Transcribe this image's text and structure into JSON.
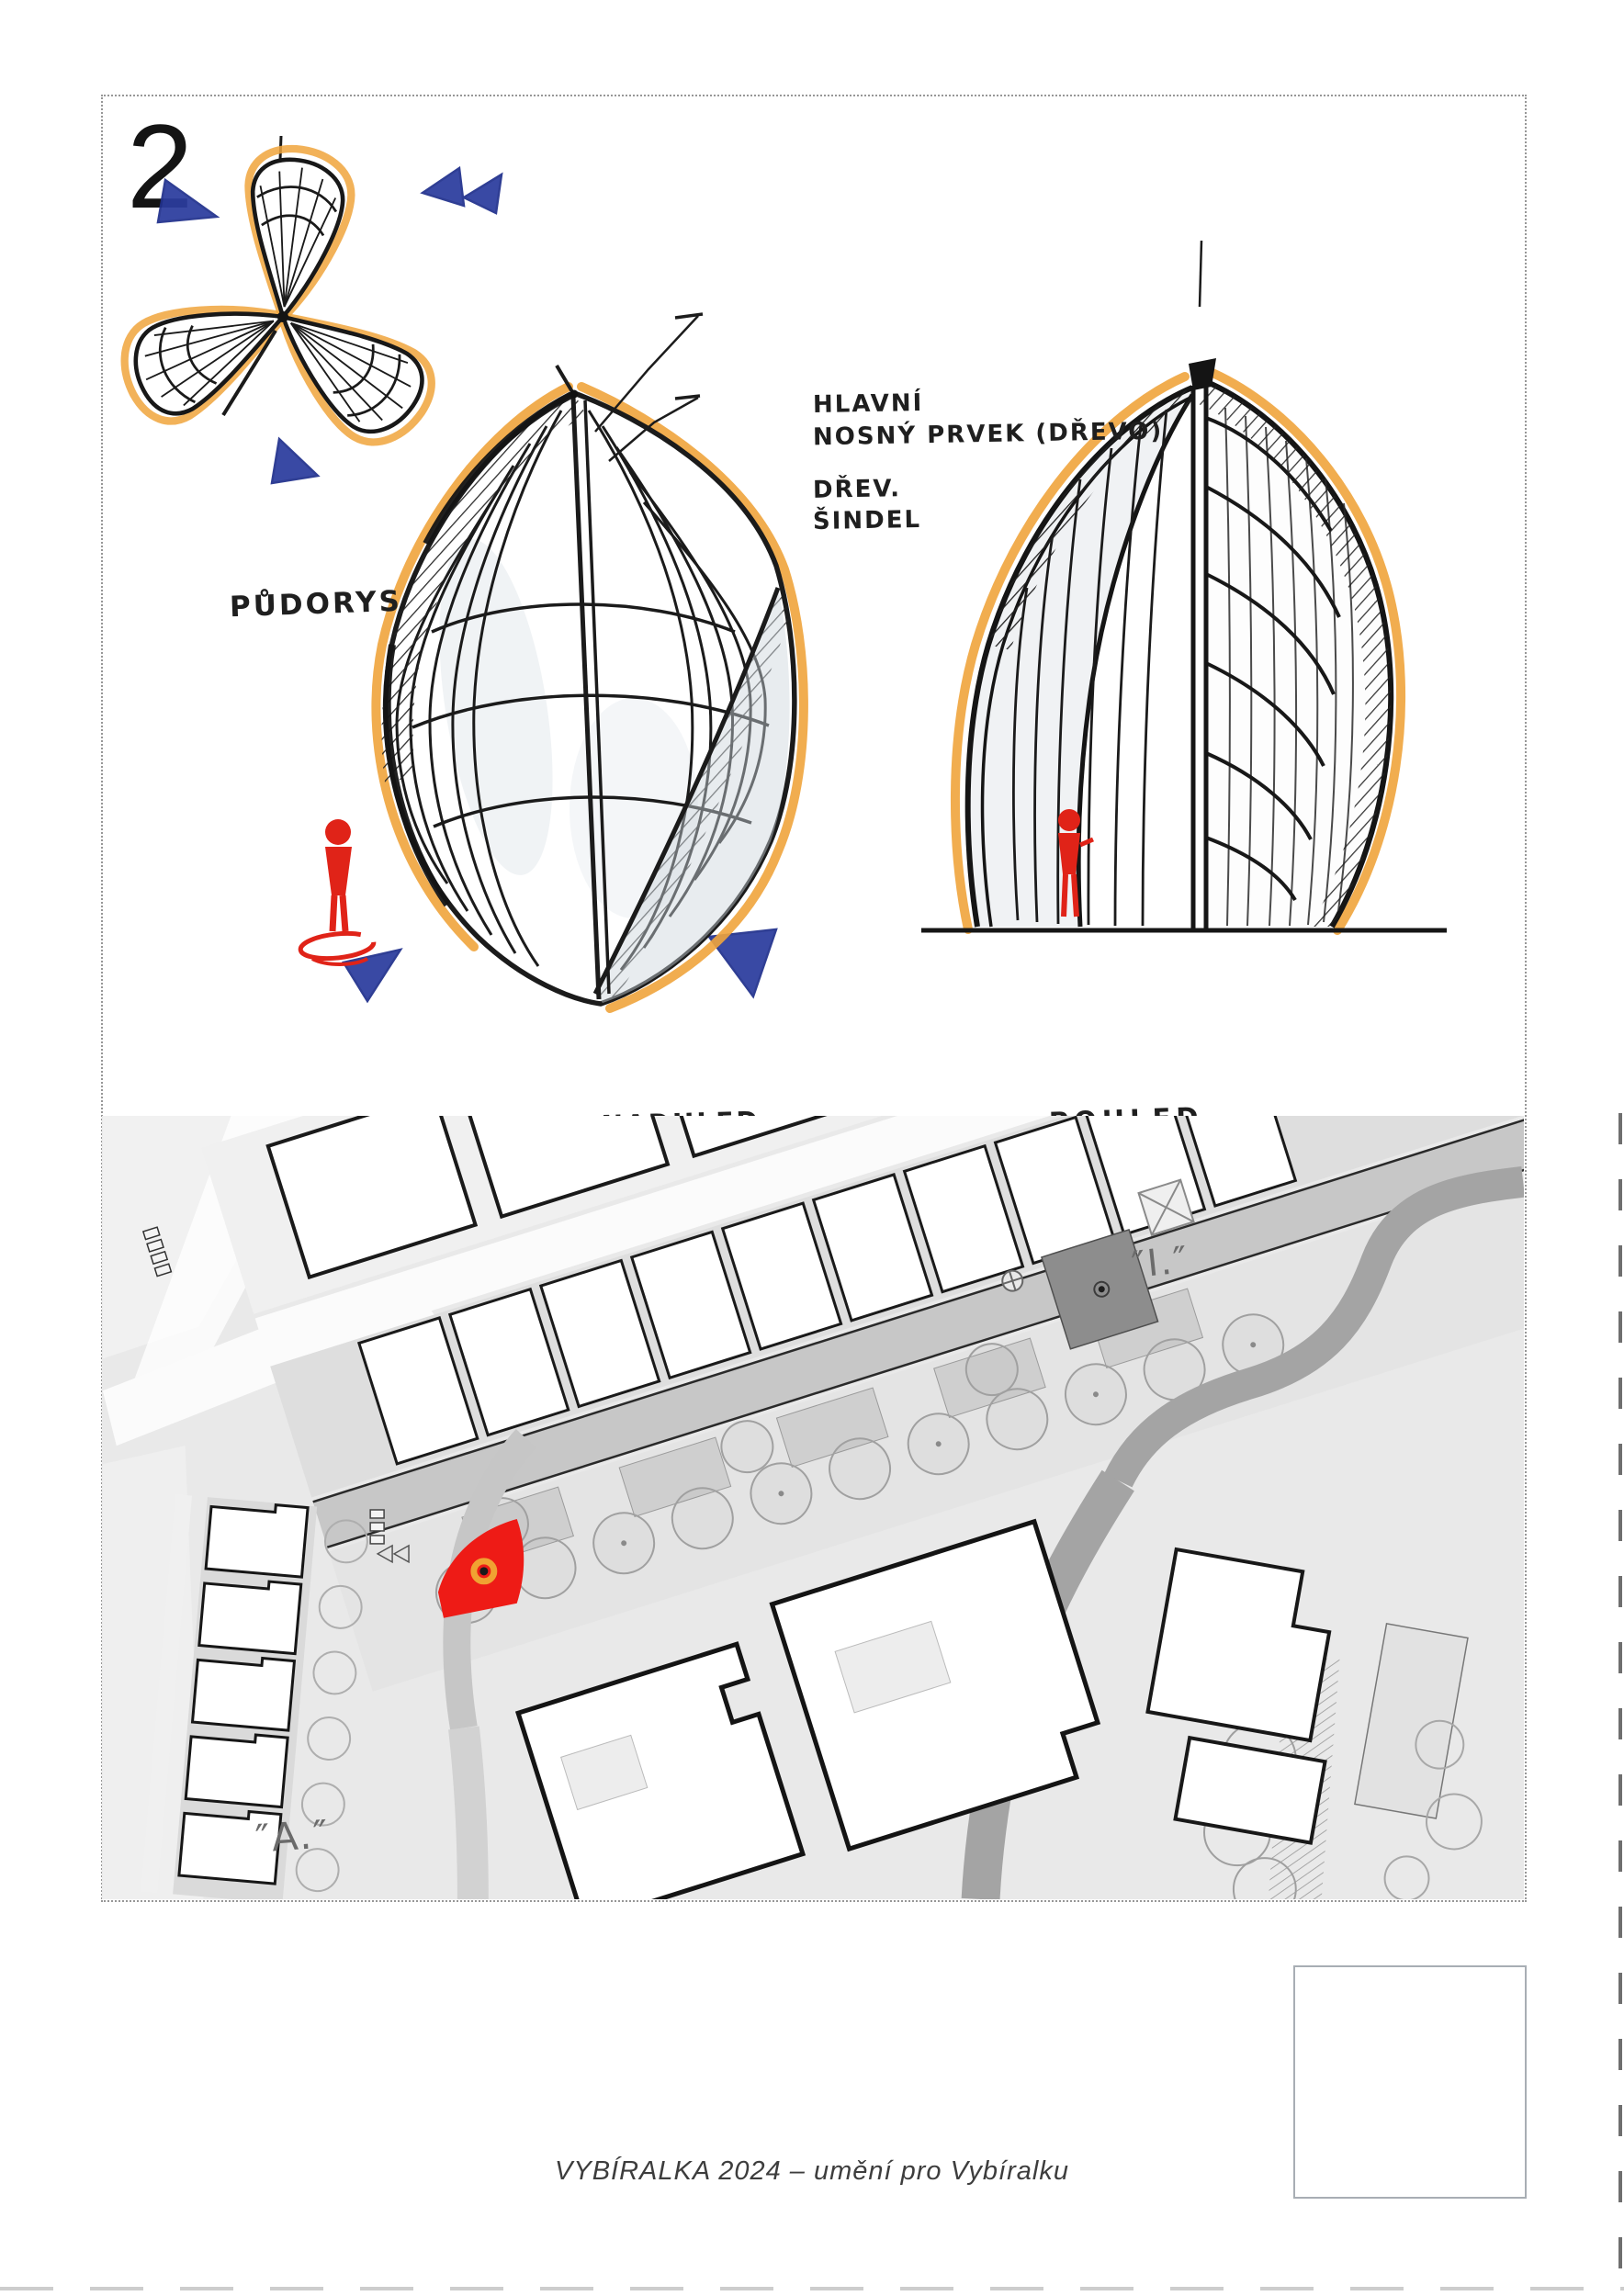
{
  "page": {
    "number": "2",
    "footer_text": "VYBÍRALKA 2024 – umění pro Vybíralku"
  },
  "sketches": {
    "plan_label": "PŮDORYS",
    "perspective_label": "PERSPEKTIVA - NADHLED",
    "elevation_label": "POHLED",
    "annotations": {
      "structure": {
        "line1": "HLAVNÍ",
        "line2": "NOSNÝ PRVEK (DŘEVO)"
      },
      "cladding": {
        "line1": "DŘEV.",
        "line2": "ŠINDEL"
      }
    }
  },
  "site_plan": {
    "street_label": "″I.″",
    "block_label": "″A.″",
    "marker_color": "#ee1b16",
    "marker_ring_color": "#f0a232"
  },
  "colors": {
    "ink": "#1a1a1a",
    "marker_orange": "#f0a43c",
    "pen_blue": "#2b3c9e",
    "figure_red": "#e02318",
    "map_background": "#e9e9e9",
    "map_road": "#a4a4a4"
  }
}
